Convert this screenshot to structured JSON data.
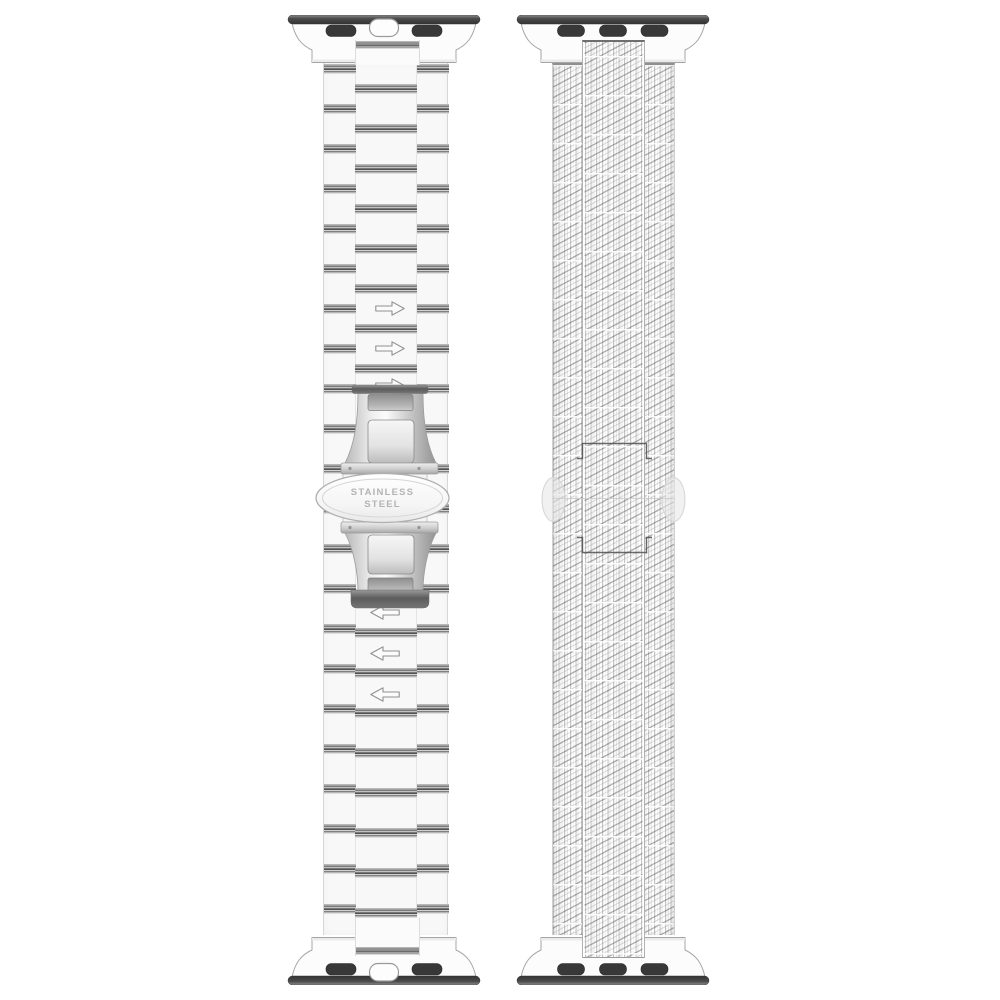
{
  "page": {
    "background": "#ffffff"
  },
  "colors": {
    "band_white": "#f8f8f8",
    "link_gap_dark": "#525252",
    "link_gap_mid": "#9b9b9b",
    "link_gap_light": "#c2c2c2",
    "adapter_bar_dark": "#3a3a3a",
    "adapter_slot_dark": "#383838",
    "adapter_body_white": "#fcfcfc",
    "outline_gray": "#a6a6a6",
    "mesh_line_gray": "#9d9d9d",
    "clasp_metal_light": "#f5f5f5",
    "clasp_metal_dark": "#8c8c8c",
    "engraving_gray": "#b4b4b4",
    "ghost_outline_dark": "#4f4f4f"
  },
  "left_band": {
    "name": "stainless steel link bracelet",
    "clasp_engraving": {
      "line1": "STAINLESS",
      "line2": "STEEL"
    },
    "arrows_above_clasp": {
      "icon": "arrow-right-icon",
      "count": 3,
      "direction": "right"
    },
    "arrows_below_clasp": {
      "icon": "arrow-left-icon",
      "count": 3,
      "direction": "left"
    },
    "top_adapter": {
      "slots": 2,
      "center_pill": true
    },
    "bottom_adapter": {
      "slots": 2,
      "center_pill": true
    }
  },
  "right_band": {
    "name": "woven mesh band",
    "top_adapter": {
      "slots": 3,
      "center_pill": false
    },
    "bottom_adapter": {
      "slots": 3,
      "center_pill": false
    }
  }
}
